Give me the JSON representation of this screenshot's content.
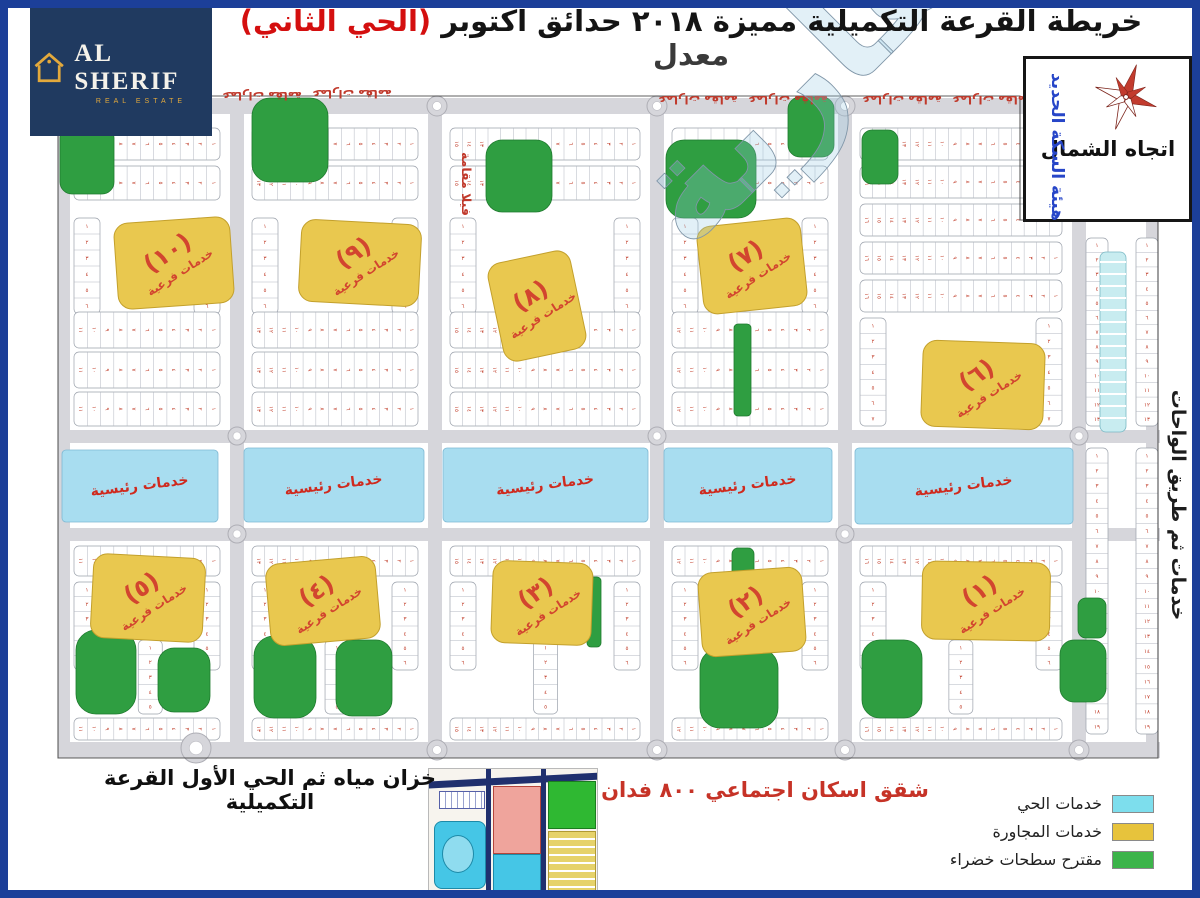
{
  "header": {
    "title_main": "خريطة القرعة التكميلية مميزة ٢٠١٨ حدائق اكتوبر ",
    "title_highlight": "(الحي الثاني)",
    "title_suffix": " معدل",
    "logo": {
      "wordmark": "AL SHERIF",
      "subtitle": "REAL ESTATE"
    }
  },
  "compass": {
    "label": "اتجاه الشمال"
  },
  "side_labels": {
    "railway": "هيئة السكة الحديد",
    "right_road": "خدمات ثم طريق الواحات"
  },
  "map": {
    "main_service_label": "خدمات رئيسية",
    "sub_service_label": "خدمات فرعية",
    "sub_service_numbers": [
      "(١٠)",
      "(٩)",
      "(٨)",
      "(٧)",
      "(٦)",
      "(٥)",
      "(٤)",
      "(٣)",
      "(٢)",
      "(١)"
    ],
    "villa_note": "فيلا مقامة",
    "top_note": "عمارات مقامة",
    "watermark": "الشريف العقارية"
  },
  "footer": {
    "left_note": "خزان مياه ثم الحي الأول القرعة التكميلية",
    "center_note": "شقق اسكان اجتماعي ٨٠٠ فدان"
  },
  "legend": {
    "items": [
      {
        "label": "خدمات الحي",
        "color": "#7ddeed"
      },
      {
        "label": "خدمات المجاورة",
        "color": "#e7c33c"
      },
      {
        "label": "مقترح سطحات خضراء",
        "color": "#3cb44a"
      }
    ]
  },
  "colors": {
    "frame_border": "#1c3f99",
    "brand_navy": "#203a60",
    "plot_number_red": "#c2402d",
    "service_strip_blue": "#a8ddf0",
    "sub_service_yellow": "#e9c84f",
    "green_area": "#2f9e41",
    "road_gray": "#d6d6db"
  }
}
